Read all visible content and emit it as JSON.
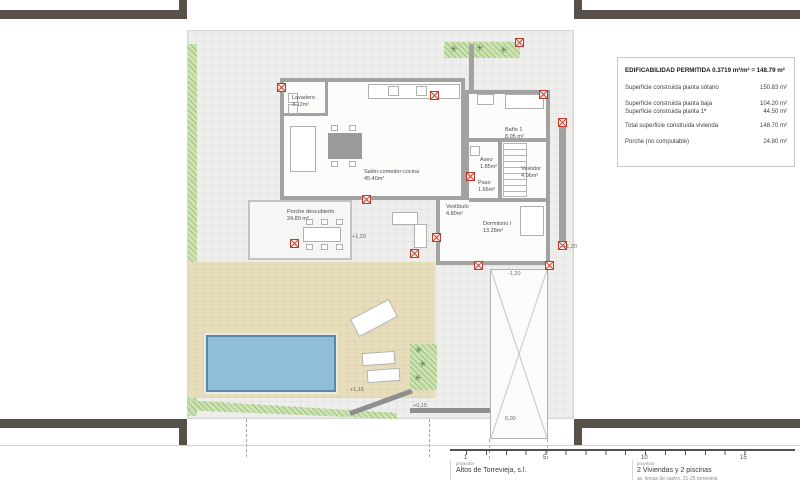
{
  "drawing": {
    "info_box": {
      "title": "EDIFICABILIDAD PERMITIDA 0.3719 m²/m² = 148.79 m²",
      "rows": [
        {
          "label": "Superficie construida planta sótano",
          "value": "150.83 m²"
        },
        {
          "label": "Superficie construida planta baja",
          "value": "104.20 m²"
        },
        {
          "label": "Superficie construida planta 1ª",
          "value": "44.50 m²"
        },
        {
          "label": "Total superficie construida vivienda",
          "value": "148.70 m²"
        },
        {
          "label": "Porche (no computable)",
          "value": "24.80 m²"
        }
      ]
    },
    "rooms": [
      {
        "name": "Lavadero",
        "area": "3.12m²"
      },
      {
        "name": "Salón-comedor-cocina",
        "area": "45.40m²"
      },
      {
        "name": "Baño 1",
        "area": "8.05 m²"
      },
      {
        "name": "Aseo",
        "area": "1.85m²"
      },
      {
        "name": "Vestidor",
        "area": "4.06m²"
      },
      {
        "name": "Paso",
        "area": "1.66m²"
      },
      {
        "name": "Vestíbulo",
        "area": "4.80m²"
      },
      {
        "name": "Dormitorio I",
        "area": "13.28m²"
      },
      {
        "name": "Porche descubierto",
        "area": "24.80 m²"
      }
    ],
    "levels": {
      "porche": "+1,20",
      "terraza_este": "+1,20",
      "rampa": "-1,20",
      "solarium": "+1,15",
      "acera": "+0,15"
    },
    "dimensions": {
      "rampa_ancho": "6,00"
    },
    "scalebar": {
      "ticks": [
        "1",
        "5",
        "10",
        "15"
      ]
    },
    "titleblock": {
      "promotor_label": "promotor",
      "promotor_name": "Altos de Torrevieja, s.l.",
      "proyecto_label": "proyecto",
      "proyecto_name": "2 Viviendas y 2 piscinas",
      "proyecto_address": "av. lomas de castro, 21-25 torrevieja"
    },
    "plant_glyph": "✳"
  }
}
